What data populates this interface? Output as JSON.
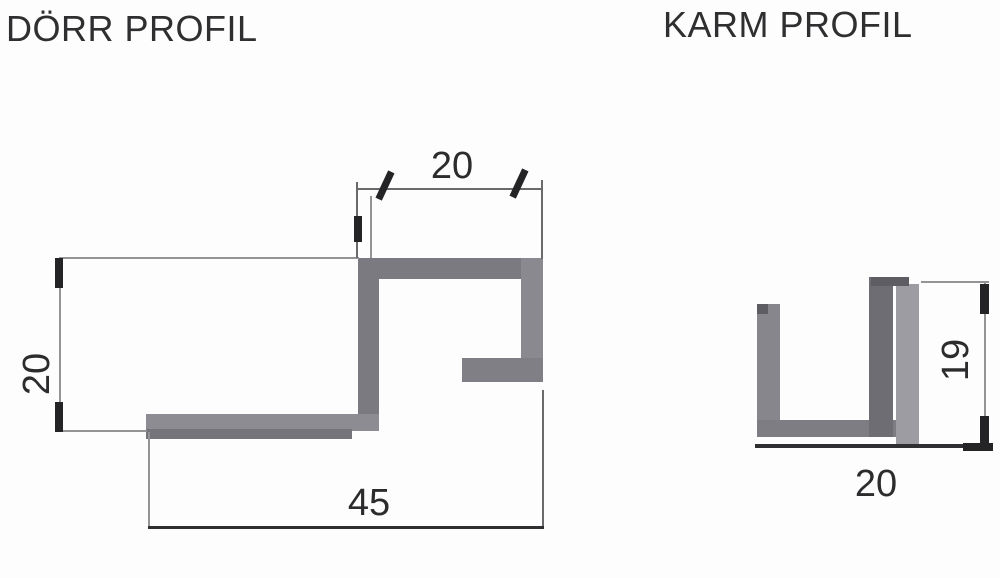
{
  "door_profile": {
    "title": "DÖRR PROFIL",
    "dim_top_width": "20",
    "dim_left_height": "20",
    "dim_bottom_width": "45"
  },
  "karm_profile": {
    "title": "KARM PROFIL",
    "dim_height": "19",
    "dim_bottom_width": "20"
  },
  "colors": {
    "background": "#fdfdfd",
    "profile_gray": "#7b7a81",
    "profile_gray_light": "#9d9ca2",
    "profile_gray_dark": "#6e6d73",
    "dimension_line_light": "#949497",
    "dimension_line_dark": "#2f2f31",
    "text": "#2c2c2e"
  }
}
